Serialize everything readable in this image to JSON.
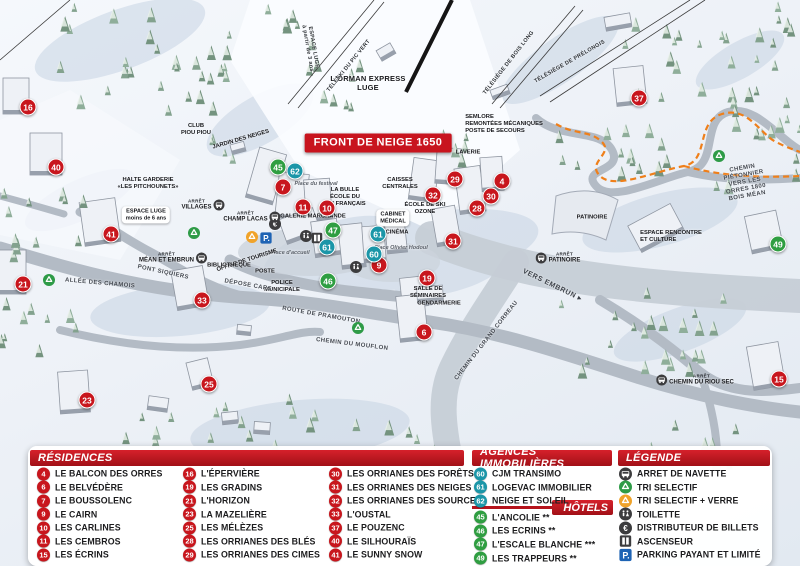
{
  "colors": {
    "residence": "#c8161d",
    "agency": "#1b96a8",
    "hotel": "#2f9e41",
    "header_red": "#b5131c",
    "banner_red": "#c8141e",
    "path_orange": "#ef7f1a"
  },
  "map": {
    "banner": "FRONT DE NEIGE 1650",
    "markers": [
      {
        "n": "16",
        "t": "r",
        "x": 28,
        "y": 107
      },
      {
        "n": "40",
        "t": "r",
        "x": 56,
        "y": 167
      },
      {
        "n": "41",
        "t": "r",
        "x": 111,
        "y": 234
      },
      {
        "n": "21",
        "t": "r",
        "x": 23,
        "y": 284
      },
      {
        "n": "33",
        "t": "r",
        "x": 202,
        "y": 300
      },
      {
        "n": "23",
        "t": "r",
        "x": 87,
        "y": 400
      },
      {
        "n": "25",
        "t": "r",
        "x": 209,
        "y": 384
      },
      {
        "n": "7",
        "t": "r",
        "x": 283,
        "y": 187
      },
      {
        "n": "11",
        "t": "r",
        "x": 303,
        "y": 207
      },
      {
        "n": "10",
        "t": "r",
        "x": 327,
        "y": 208
      },
      {
        "n": "29",
        "t": "r",
        "x": 455,
        "y": 179
      },
      {
        "n": "32",
        "t": "r",
        "x": 433,
        "y": 195
      },
      {
        "n": "4",
        "t": "r",
        "x": 502,
        "y": 181
      },
      {
        "n": "30",
        "t": "r",
        "x": 491,
        "y": 196
      },
      {
        "n": "28",
        "t": "r",
        "x": 477,
        "y": 208
      },
      {
        "n": "31",
        "t": "r",
        "x": 453,
        "y": 241
      },
      {
        "n": "9",
        "t": "r",
        "x": 379,
        "y": 265
      },
      {
        "n": "19",
        "t": "r",
        "x": 427,
        "y": 278
      },
      {
        "n": "6",
        "t": "r",
        "x": 424,
        "y": 332
      },
      {
        "n": "37",
        "t": "r",
        "x": 639,
        "y": 98
      },
      {
        "n": "15",
        "t": "r",
        "x": 779,
        "y": 379
      },
      {
        "n": "62",
        "t": "a",
        "x": 295,
        "y": 171
      },
      {
        "n": "61",
        "t": "a",
        "x": 327,
        "y": 247
      },
      {
        "n": "61",
        "t": "a",
        "x": 378,
        "y": 234
      },
      {
        "n": "60",
        "t": "a",
        "x": 374,
        "y": 254
      },
      {
        "n": "45",
        "t": "h",
        "x": 278,
        "y": 167
      },
      {
        "n": "47",
        "t": "h",
        "x": 333,
        "y": 230
      },
      {
        "n": "46",
        "t": "h",
        "x": 328,
        "y": 281
      },
      {
        "n": "49",
        "t": "h",
        "x": 778,
        "y": 244
      }
    ],
    "labels": [
      {
        "t": "L'ORMAN EXPRESS\nLUGE",
        "x": 368,
        "y": 84,
        "s": "poi-lg"
      },
      {
        "t": "ESPACE LUGE\nà partir de 3 ans",
        "x": 310,
        "y": 48,
        "s": "lift",
        "r": 80
      },
      {
        "t": "TÉLÉSKI DU PIC VERT",
        "x": 349,
        "y": 66,
        "s": "lift",
        "r": -51
      },
      {
        "t": "TÉLÉSIÈGE DE BOIS LONG",
        "x": 509,
        "y": 63,
        "s": "lift",
        "r": -52
      },
      {
        "t": "TÉLÉSIÈGE DE PRÉLONGIS",
        "x": 570,
        "y": 62,
        "s": "lift",
        "r": -30
      },
      {
        "t": "SEMLORE\nREMONTÉES MÉCANIQUES\nPOSTE DE SECOURS",
        "x": 504,
        "y": 124,
        "s": "poi-sm left"
      },
      {
        "t": "CLUB\nPIOU PIOU",
        "x": 196,
        "y": 130,
        "s": "poi-sm"
      },
      {
        "t": "JARDIN DES NEIGES",
        "x": 241,
        "y": 140,
        "s": "poi-sm",
        "r": -16
      },
      {
        "t": "HALTE GARDERIE\n«LES PITCHOUNETS»",
        "x": 148,
        "y": 184,
        "s": "poi-sm"
      },
      {
        "t": "ESPACE LUGE\nmoins de 6 ans",
        "x": 146,
        "y": 215,
        "s": "bubble"
      },
      {
        "t": "GALERIE MARCHANDE",
        "x": 313,
        "y": 217,
        "s": "poi-sm"
      },
      {
        "t": "LA BULLE\nÉCOLE DU\nSKI FRANÇAIS",
        "x": 345,
        "y": 197,
        "s": "poi-sm"
      },
      {
        "t": "CAISSES\nCENTRALES",
        "x": 400,
        "y": 184,
        "s": "poi-sm"
      },
      {
        "t": "ÉCOLE DE SKI\nOZONE",
        "x": 425,
        "y": 209,
        "s": "poi-sm"
      },
      {
        "t": "CABINET\nMÉDICAL",
        "x": 393,
        "y": 218,
        "s": "bubble"
      },
      {
        "t": "CINÉMA",
        "x": 397,
        "y": 233,
        "s": "poi-sm"
      },
      {
        "t": "LAVERIE",
        "x": 468,
        "y": 153,
        "s": "poi-sm"
      },
      {
        "t": "Place Olivier Hodoul",
        "x": 401,
        "y": 248,
        "s": "place"
      },
      {
        "t": "Place du festival",
        "x": 316,
        "y": 184,
        "s": "place"
      },
      {
        "t": "Place d'accueil",
        "x": 290,
        "y": 253,
        "s": "place"
      },
      {
        "t": "OFFICE DE TOURISME",
        "x": 247,
        "y": 261,
        "s": "poi-sm",
        "r": -18
      },
      {
        "t": "POSTE",
        "x": 265,
        "y": 272,
        "s": "poi-sm"
      },
      {
        "t": "POLICE\nMUNICIPALE",
        "x": 282,
        "y": 287,
        "s": "poi-sm"
      },
      {
        "t": "BIBLIOTHÈQUE",
        "x": 229,
        "y": 266,
        "s": "poi-sm"
      },
      {
        "t": "DÉPOSE CARS",
        "x": 248,
        "y": 286,
        "s": "road",
        "r": 10
      },
      {
        "t": "PONT SIQUIERS",
        "x": 163,
        "y": 273,
        "s": "road",
        "r": 12
      },
      {
        "t": "ALLÉE DES CHAMOIS",
        "x": 100,
        "y": 284,
        "s": "road",
        "r": 5
      },
      {
        "t": "ROUTE DE PRAMOUTON",
        "x": 321,
        "y": 316,
        "s": "road",
        "r": 10
      },
      {
        "t": "CHEMIN DU MOUFLON",
        "x": 352,
        "y": 345,
        "s": "road",
        "r": 7
      },
      {
        "t": "CHEMIN DU GRAND CORREAU",
        "x": 487,
        "y": 341,
        "s": "road",
        "r": -52
      },
      {
        "t": "VERS EMBRUN ▸",
        "x": 552,
        "y": 286,
        "s": "road-dir",
        "r": 26
      },
      {
        "t": "CHEMIN PIÉTONNIER\nVERS LES ORRES 1800\nBOIS MÉAN",
        "x": 745,
        "y": 183,
        "s": "road",
        "r": -10
      },
      {
        "t": "SALLE DE\nSÉMINAIRES",
        "x": 428,
        "y": 293,
        "s": "poi-sm"
      },
      {
        "t": "GENDARMERIE",
        "x": 439,
        "y": 304,
        "s": "poi-sm"
      },
      {
        "t": "PATINOIRE",
        "x": 592,
        "y": 218,
        "s": "poi-sm"
      },
      {
        "t": "ESPACE RENCONTRE\nET CULTURE",
        "x": 671,
        "y": 237,
        "s": "poi-sm left"
      }
    ],
    "bus_stop_word": "ARRÊT",
    "bus_stops": [
      {
        "name": "VILLAGES",
        "x": 203,
        "y": 205,
        "side": "right"
      },
      {
        "name": "CHAMP LACAS",
        "x": 252,
        "y": 217,
        "side": "right"
      },
      {
        "name": "MÉAN ET EMBRUN",
        "x": 173,
        "y": 258,
        "side": "right"
      },
      {
        "name": "PATINOIRE",
        "x": 558,
        "y": 258,
        "side": "left"
      },
      {
        "name": "CHEMIN DU RIOU SEC",
        "x": 695,
        "y": 380,
        "side": "left"
      }
    ],
    "icons": [
      {
        "type": "euro",
        "x": 275,
        "y": 224
      },
      {
        "type": "toilet",
        "x": 306,
        "y": 236
      },
      {
        "type": "elevator",
        "x": 317,
        "y": 238
      },
      {
        "type": "toilet",
        "x": 356,
        "y": 267
      },
      {
        "type": "recycle-green",
        "x": 49,
        "y": 280
      },
      {
        "type": "recycle-green",
        "x": 194,
        "y": 233
      },
      {
        "type": "recycle-green",
        "x": 358,
        "y": 328
      },
      {
        "type": "recycle-green",
        "x": 719,
        "y": 156
      },
      {
        "type": "recycle-orange",
        "x": 252,
        "y": 237
      },
      {
        "type": "parking",
        "x": 266,
        "y": 238
      }
    ]
  },
  "panel": {
    "residences": {
      "title": "RÉSIDENCES",
      "items": [
        {
          "n": "4",
          "label": "LE BALCON DES ORRES"
        },
        {
          "n": "6",
          "label": "LE BELVÉDÈRE"
        },
        {
          "n": "7",
          "label": "LE BOUSSOLENC"
        },
        {
          "n": "9",
          "label": "LE CAIRN"
        },
        {
          "n": "10",
          "label": "LES CARLINES"
        },
        {
          "n": "11",
          "label": "LES CEMBROS"
        },
        {
          "n": "15",
          "label": "LES ÉCRINS"
        },
        {
          "n": "16",
          "label": "L'ÉPERVIÈRE"
        },
        {
          "n": "19",
          "label": "LES GRADINS"
        },
        {
          "n": "21",
          "label": "L'HORIZON"
        },
        {
          "n": "23",
          "label": "LA MAZELIÈRE"
        },
        {
          "n": "25",
          "label": "LES MÉLÈZES"
        },
        {
          "n": "28",
          "label": "LES ORRIANES DES BLÉS"
        },
        {
          "n": "29",
          "label": "LES ORRIANES DES CIMES"
        },
        {
          "n": "30",
          "label": "LES ORRIANES DES FORÊTS"
        },
        {
          "n": "31",
          "label": "LES ORRIANES DES NEIGES"
        },
        {
          "n": "32",
          "label": "LES ORRIANES DES SOURCES"
        },
        {
          "n": "33",
          "label": "L'OUSTAL"
        },
        {
          "n": "37",
          "label": "LE POUZENC"
        },
        {
          "n": "40",
          "label": "LE SILHOURAÏS"
        },
        {
          "n": "41",
          "label": "LE SUNNY SNOW"
        }
      ]
    },
    "agencies": {
      "title": "AGENCES IMMOBILIÈRES",
      "items": [
        {
          "n": "60",
          "label": "CJM TRANSIMO"
        },
        {
          "n": "61",
          "label": "LOGEVAC IMMOBILIER"
        },
        {
          "n": "62",
          "label": "NEIGE ET SOLEIL"
        }
      ]
    },
    "hotels": {
      "title": "HÔTELS",
      "items": [
        {
          "n": "45",
          "label": "L'ANCOLIE **"
        },
        {
          "n": "46",
          "label": "LES ECRINS **"
        },
        {
          "n": "47",
          "label": "L'ESCALE BLANCHE ***"
        },
        {
          "n": "49",
          "label": "LES TRAPPEURS **"
        }
      ]
    },
    "legend": {
      "title": "LÉGENDE",
      "items": [
        {
          "icon": "bus",
          "label": "ARRET DE NAVETTE"
        },
        {
          "icon": "recycle-green",
          "label": "TRI SELECTIF"
        },
        {
          "icon": "recycle-orange",
          "label": "TRI SELECTIF + VERRE"
        },
        {
          "icon": "toilet",
          "label": "TOILETTE"
        },
        {
          "icon": "euro",
          "label": "DISTRIBUTEUR DE BILLETS"
        },
        {
          "icon": "elevator",
          "label": "ASCENSEUR"
        },
        {
          "icon": "parking",
          "label": "PARKING PAYANT ET LIMITÉ"
        }
      ]
    }
  }
}
